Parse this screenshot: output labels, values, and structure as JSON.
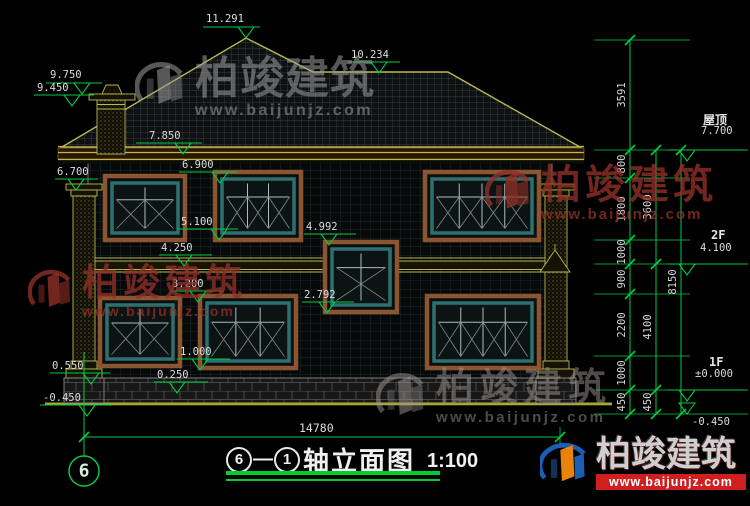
{
  "drawing": {
    "title_axis_start": "6",
    "title_dash": "—",
    "title_axis_end": "1",
    "title_text": "轴立面图",
    "title_scale": "1:100",
    "axis_bubble": "6",
    "bottom_width_dim": "14780"
  },
  "markers": [
    "11.291",
    "10.234",
    "9.750",
    "9.450",
    "7.850",
    "6.900",
    "6.700",
    "5.100",
    "4.992",
    "4.250",
    "3.200",
    "2.792",
    "1.000",
    "0.250",
    "0.550",
    "-0.450"
  ],
  "right_levels": [
    {
      "label": "屋顶",
      "value": "7.700"
    },
    {
      "label": "2F",
      "value": "4.100"
    },
    {
      "label": "1F",
      "value": "±0.000"
    },
    {
      "label": "",
      "value": "-0.450"
    }
  ],
  "dims": {
    "inner": [
      "3591",
      "800",
      "1800",
      "1000",
      "900",
      "2200",
      "1000",
      "450"
    ],
    "middle": [
      "3600",
      "4100",
      "450"
    ],
    "outer": [
      "8150"
    ]
  },
  "watermark": {
    "brand": "柏竣建筑",
    "url": "www.baijunjz.com"
  },
  "colors": {
    "background": "#000000",
    "dimension_green": "#00cc44",
    "outline_yellow": "#b9b950",
    "window_frame_brown": "#8a5530",
    "window_frame_teal": "#2e7070",
    "text_white": "#dcdcdc",
    "watermark_red": "#94302a",
    "watermark_grey": "#9e9e9e",
    "logo_banner_red": "#cf1f1f"
  }
}
